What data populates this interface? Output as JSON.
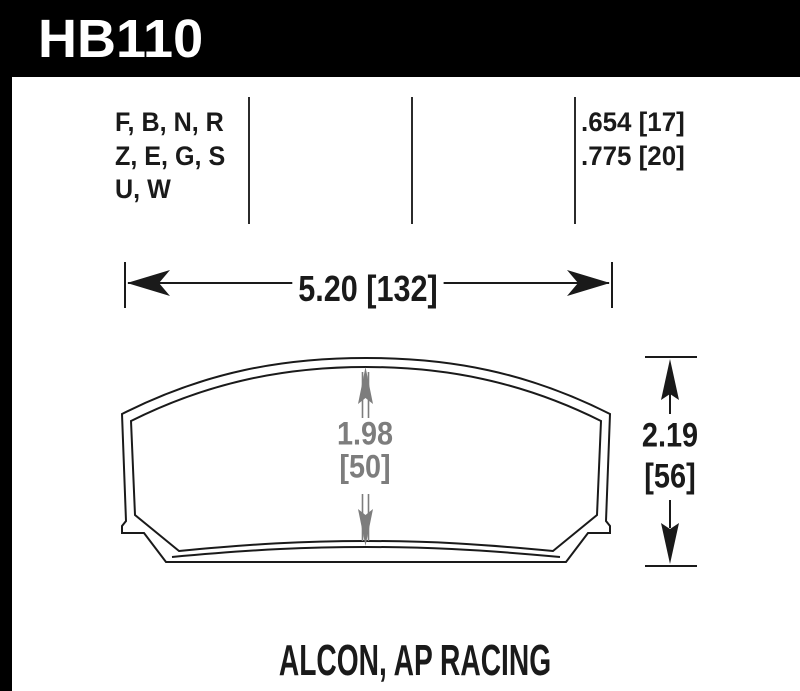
{
  "part": {
    "number": "HB110"
  },
  "compounds": {
    "lines": [
      "F, B, N, R",
      "Z, E, G, S",
      "U, W"
    ]
  },
  "thickness": {
    "values": [
      ".654 [17]",
      ".775 [20]"
    ]
  },
  "dimensions": {
    "width": "5.20 [132]",
    "pad_height": {
      "value": "1.98",
      "metric": "[50]"
    },
    "overall_height": {
      "value": "2.19",
      "metric": "[56]"
    }
  },
  "footer": {
    "applications": "ALCON, AP RACING"
  },
  "colors": {
    "header_bg": "#000000",
    "ink": "#1a1a1a",
    "dimension_gray": "#7d7d7d",
    "page_bg": "#ffffff"
  }
}
